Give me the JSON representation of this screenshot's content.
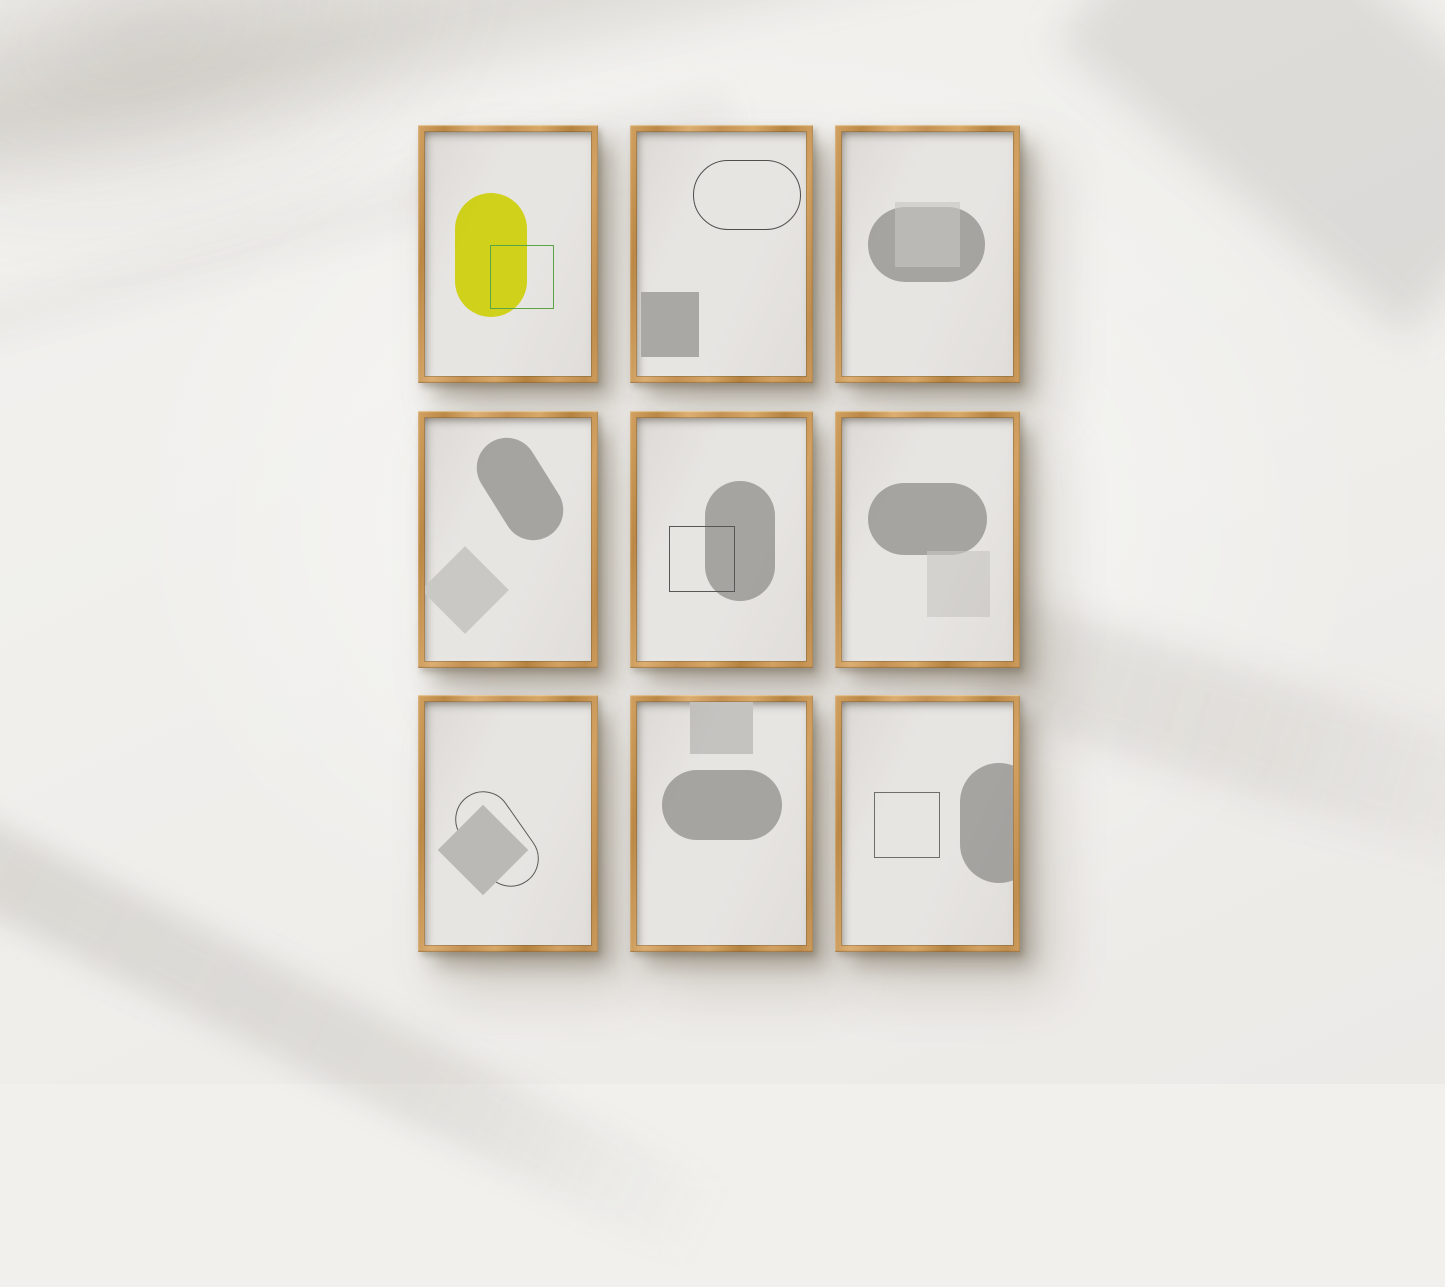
{
  "scene": {
    "description": "Gallery wall mockup photo: nine light-oak wooden box frames hung in a 3x3 grid on a white wall with soft diagonal window-light shadows. Each frame holds a minimalist abstract print of overlapping pills, squares and diamonds.",
    "palette": {
      "wall": "#f1f0ed",
      "frame_wood": "#c9975a",
      "print_background": "#e7e5e2",
      "shape_gray": "#a5a4a1",
      "shape_light_gray": "#c8c7c4",
      "accent_yellow": "#d0d11a",
      "accent_green": "#5aa546",
      "outline_dark": "#4f4e4c"
    }
  },
  "frames": [
    {
      "name": "frame-top-left",
      "x": 418,
      "y": 125,
      "w": 180,
      "h": 258,
      "shapes": [
        {
          "type": "pill",
          "x": 30,
          "y": 61,
          "w": 72,
          "h": 124,
          "fill": "#d0d11a"
        },
        {
          "type": "square-outline",
          "x": 65,
          "y": 113,
          "w": 64,
          "h": 64,
          "stroke": "#5aa546"
        }
      ]
    },
    {
      "name": "frame-top-center",
      "x": 630,
      "y": 125,
      "w": 183,
      "h": 258,
      "shapes": [
        {
          "type": "pill-outline",
          "x": 56,
          "y": 28,
          "w": 108,
          "h": 70,
          "stroke": "#4f4e4c"
        },
        {
          "type": "square",
          "x": 4,
          "y": 160,
          "w": 58,
          "h": 65,
          "fill": "#a9a8a5"
        }
      ]
    },
    {
      "name": "frame-top-right",
      "x": 835,
      "y": 125,
      "w": 185,
      "h": 258,
      "shapes": [
        {
          "type": "pill",
          "x": 26,
          "y": 75,
          "w": 117,
          "h": 75,
          "fill": "#a5a4a1"
        },
        {
          "type": "square",
          "x": 53,
          "y": 70,
          "w": 65,
          "h": 65,
          "fill": "#c8c7c4",
          "opacity": 0.62
        }
      ]
    },
    {
      "name": "frame-middle-left",
      "x": 418,
      "y": 411,
      "w": 180,
      "h": 257,
      "shapes": [
        {
          "type": "pill",
          "x": 65,
          "y": 16,
          "w": 60,
          "h": 110,
          "rotate": -32,
          "fill": "#a5a4a1"
        },
        {
          "type": "diamond",
          "x": 9,
          "y": 141,
          "w": 62,
          "h": 62,
          "fill": "#c9c8c5"
        }
      ]
    },
    {
      "name": "frame-middle-center",
      "x": 630,
      "y": 411,
      "w": 183,
      "h": 257,
      "shapes": [
        {
          "type": "pill",
          "x": 68,
          "y": 63,
          "w": 70,
          "h": 120,
          "fill": "#a5a4a1"
        },
        {
          "type": "square-outline",
          "x": 32,
          "y": 108,
          "w": 66,
          "h": 66,
          "stroke": "#585755"
        }
      ]
    },
    {
      "name": "frame-middle-right",
      "x": 835,
      "y": 411,
      "w": 185,
      "h": 257,
      "shapes": [
        {
          "type": "pill",
          "x": 26,
          "y": 65,
          "w": 119,
          "h": 72,
          "fill": "#a5a4a1"
        },
        {
          "type": "square",
          "x": 85,
          "y": 133,
          "w": 63,
          "h": 66,
          "fill": "#c8c7c4",
          "opacity": 0.62
        }
      ]
    },
    {
      "name": "frame-bottom-left",
      "x": 418,
      "y": 695,
      "w": 180,
      "h": 257,
      "shapes": [
        {
          "type": "pill-outline",
          "x": 44,
          "y": 85,
          "w": 56,
          "h": 104,
          "rotate": -35,
          "stroke": "#5a5955"
        },
        {
          "type": "diamond",
          "x": 26,
          "y": 116,
          "w": 64,
          "h": 64,
          "fill": "#bab9b6"
        }
      ]
    },
    {
      "name": "frame-bottom-center",
      "x": 630,
      "y": 695,
      "w": 183,
      "h": 257,
      "shapes": [
        {
          "type": "square",
          "x": 53,
          "y": 0,
          "w": 63,
          "h": 52,
          "fill": "#c4c3c0"
        },
        {
          "type": "pill",
          "x": 25,
          "y": 68,
          "w": 120,
          "h": 70,
          "fill": "#a5a4a1"
        }
      ]
    },
    {
      "name": "frame-bottom-right",
      "x": 835,
      "y": 695,
      "w": 185,
      "h": 257,
      "shapes": [
        {
          "type": "square-outline",
          "x": 32,
          "y": 90,
          "w": 66,
          "h": 66,
          "stroke": "#6e6d6a"
        },
        {
          "type": "pill",
          "x": 118,
          "y": 61,
          "w": 78,
          "h": 120,
          "fill": "#a5a4a1"
        }
      ]
    }
  ]
}
